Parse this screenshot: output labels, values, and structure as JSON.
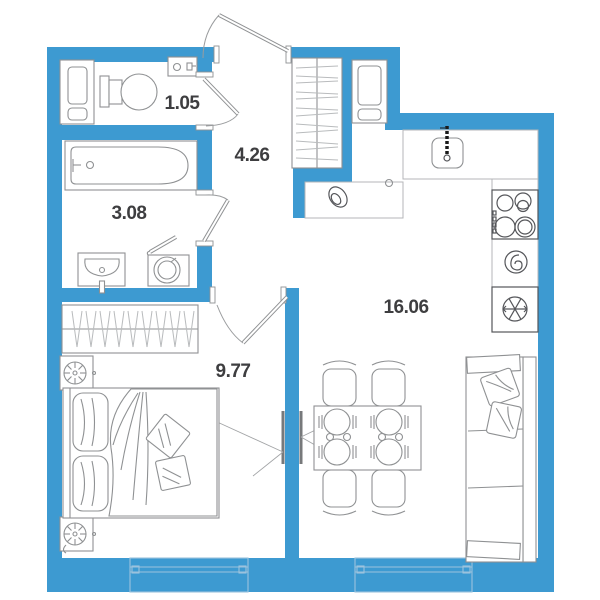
{
  "title": "Apartment floor plan",
  "rooms": [
    {
      "id": "wc",
      "label": "1.05"
    },
    {
      "id": "hallway",
      "label": "4.26"
    },
    {
      "id": "bathroom",
      "label": "3.08"
    },
    {
      "id": "bedroom",
      "label": "9.77"
    },
    {
      "id": "kitchen-living",
      "label": "16.06"
    }
  ],
  "colors": {
    "wall": "#3d9ad1",
    "window_fill": "#d8eaf6",
    "window_line": "#9cc3dd",
    "label": "#3e3e40",
    "furniture_line": "#8f9193"
  },
  "icons": [
    "entrance-door-icon",
    "interior-door-icon",
    "toilet-icon",
    "washbasin-icon",
    "bathtub-icon",
    "washing-machine-icon",
    "storage-cabinet-icon",
    "wardrobe-icon",
    "kitchen-sink-icon",
    "faucet-icon",
    "cooktop-icon",
    "oven-icon",
    "refrigerator-icon",
    "snowflake-icon",
    "dining-table-icon",
    "chair-icon",
    "plate-setting-icon",
    "tv-icon",
    "sofa-icon",
    "double-bed-icon",
    "pillow-icon",
    "nightstand-icon",
    "lamp-icon",
    "window-icon",
    "decor-vase-icon"
  ]
}
